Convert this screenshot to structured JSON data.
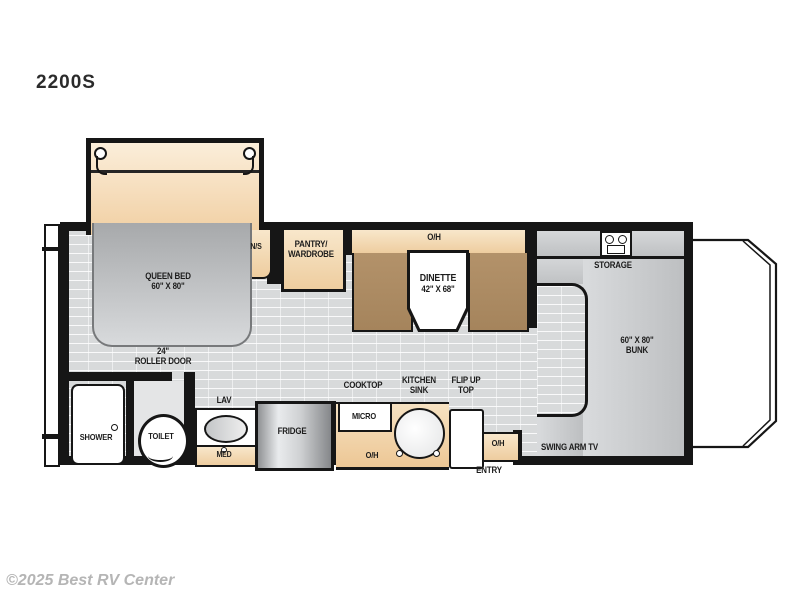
{
  "title": "2200S",
  "watermark": "©2025 Best RV Center",
  "labels": {
    "queen_bed_1": "QUEEN BED",
    "queen_bed_2": "60\" X 80\"",
    "nightstand": "N/S",
    "pantry_1": "PANTRY/",
    "pantry_2": "WARDROBE",
    "dinette_oh": "O/H",
    "dinette_1": "DINETTE",
    "dinette_2": "42\" X 68\"",
    "storage": "STORAGE",
    "bunk_1": "60\" X 80\"",
    "bunk_2": "BUNK",
    "swing_arm_tv": "SWING ARM TV",
    "roller_door_1": "24\"",
    "roller_door_2": "ROLLER DOOR",
    "shower": "SHOWER",
    "toilet": "TOILET",
    "lav": "LAV",
    "med": "MED",
    "fridge": "FRIDGE",
    "micro": "MICRO",
    "cooktop": "COOKTOP",
    "kitchen_sink_1": "KITCHEN",
    "kitchen_sink_2": "SINK",
    "flip_up_1": "FLIP UP",
    "flip_up_2": "TOP",
    "entry_oh": "O/H",
    "entry": "ENTRY",
    "kitchen_oh": "O/H"
  },
  "colors": {
    "wall": "#161616",
    "floor": "#d8dadb",
    "cabinet_tan": "#f3dcb7",
    "wood_bench": "#ad8c62",
    "fixture_gray": "#c6c8ca",
    "label_text": "#1c1c1c",
    "watermark_gray": "#b5b5b5"
  }
}
